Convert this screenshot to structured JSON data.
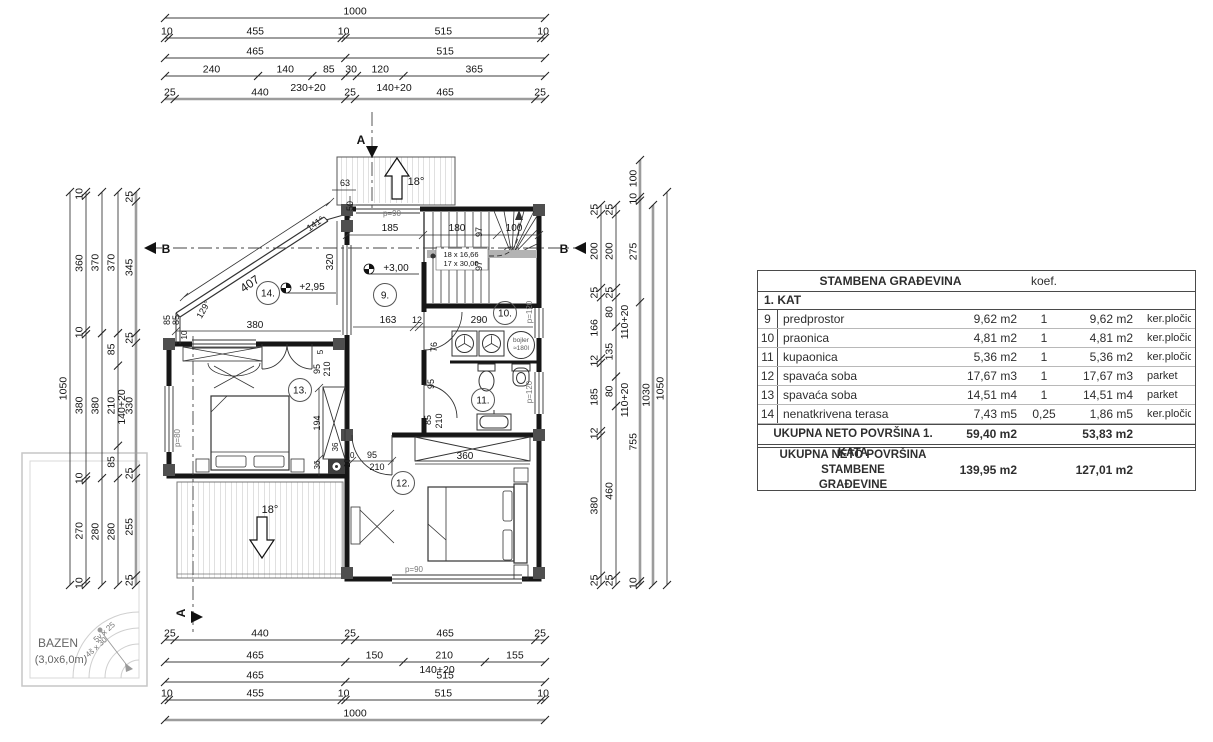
{
  "table": {
    "title": "STAMBENA GRAĐEVINA",
    "koef_header": "koef.",
    "section": "1. KAT",
    "rows": [
      {
        "n": "9",
        "name": "predprostor",
        "a": "9,62 m2",
        "k": "1",
        "a2": "9,62 m2",
        "f": "ker.pločice"
      },
      {
        "n": "10",
        "name": "praonica",
        "a": "4,81 m2",
        "k": "1",
        "a2": "4,81 m2",
        "f": "ker.pločice"
      },
      {
        "n": "11",
        "name": "kupaonica",
        "a": "5,36 m2",
        "k": "1",
        "a2": "5,36 m2",
        "f": "ker.pločice"
      },
      {
        "n": "12",
        "name": "spavaća soba",
        "a": "17,67 m3",
        "k": "1",
        "a2": "17,67 m3",
        "f": "parket"
      },
      {
        "n": "13",
        "name": "spavaća soba",
        "a": "14,51 m4",
        "k": "1",
        "a2": "14,51 m4",
        "f": "parket"
      },
      {
        "n": "14",
        "name": "nenatkrivena terasa",
        "a": "7,43 m5",
        "k": "0,25",
        "a2": "1,86 m5",
        "f": "ker.pločice"
      }
    ],
    "total1": {
      "label": "UKUPNA NETO POVRŠINA 1. KATA",
      "a": "59,40 m2",
      "a2": "53,83 m2"
    },
    "total2": {
      "label1": "UKUPNA NETO POVRŠINA STAMBENE",
      "label2": "GRAĐEVINE",
      "a": "139,95 m2",
      "a2": "127,01 m2"
    }
  },
  "dims": {
    "h": [
      {
        "y": 18,
        "x1": 165,
        "x2": 545,
        "segs": [
          "1000"
        ]
      },
      {
        "y": 38,
        "x1": 165,
        "x2": 545,
        "segs": [
          "10",
          "455",
          "10",
          "515",
          "10"
        ]
      },
      {
        "y": 58,
        "x1": 165,
        "x2": 545,
        "segs": [
          "465",
          "515"
        ]
      },
      {
        "y": 76,
        "x1": 165,
        "x2": 545,
        "segs": [
          "240",
          "140",
          "85",
          "30",
          "120",
          "365"
        ]
      },
      {
        "y": 99,
        "x1": 165,
        "x2": 545,
        "segs": [
          "25",
          "440",
          "25",
          "465",
          "25"
        ],
        "thick": true
      },
      {
        "y": 640,
        "x1": 165,
        "x2": 545,
        "segs": [
          "25",
          "440",
          "25",
          "465",
          "25"
        ]
      },
      {
        "y": 662,
        "x1": 165,
        "x2": 545,
        "segs": [
          "465",
          "150",
          "210",
          "155"
        ]
      },
      {
        "y": 682,
        "x1": 165,
        "x2": 545,
        "segs": [
          "465",
          "515"
        ]
      },
      {
        "y": 700,
        "x1": 165,
        "x2": 545,
        "segs": [
          "10",
          "455",
          "10",
          "515",
          "10"
        ]
      },
      {
        "y": 720,
        "x1": 165,
        "x2": 545,
        "segs": [
          "1000"
        ],
        "thick": true
      }
    ],
    "v": [
      {
        "x": 70,
        "y1": 192,
        "y2": 585,
        "segs": [
          "1050"
        ]
      },
      {
        "x": 86,
        "y1": 192,
        "y2": 585,
        "segs": [
          "10",
          "360",
          "10",
          "380",
          "10",
          "270",
          "10"
        ]
      },
      {
        "x": 102,
        "y1": 192,
        "y2": 585,
        "segs": [
          "370",
          "380",
          "280"
        ]
      },
      {
        "x": 118,
        "y1": 192,
        "y2": 585,
        "segs": [
          "370",
          "85",
          "210",
          "85",
          "280"
        ]
      },
      {
        "x": 136,
        "y1": 192,
        "y2": 585,
        "segs": [
          "25",
          "345",
          "25",
          "330",
          "25",
          "255",
          "25"
        ],
        "thick": true
      },
      {
        "x": 601,
        "y1": 205,
        "y2": 585,
        "segs": [
          "25",
          "200",
          "25",
          "166",
          "12",
          "185",
          "12",
          "380",
          "25"
        ]
      },
      {
        "x": 616,
        "y1": 205,
        "y2": 585,
        "segs": [
          "25",
          "200",
          "25",
          "80",
          "135",
          "80",
          "460",
          "25"
        ]
      },
      {
        "x": 640,
        "y1": 160,
        "y2": 585,
        "segs": [
          "100",
          "10",
          "275",
          "755",
          "10"
        ],
        "thick": true
      },
      {
        "x": 653,
        "y1": 205,
        "y2": 585,
        "segs": [
          "1030"
        ],
        "thick": true
      },
      {
        "x": 667,
        "y1": 192,
        "y2": 585,
        "segs": [
          "1050"
        ]
      }
    ],
    "extras": [
      {
        "t": "230+20",
        "x": 308,
        "y": 91
      },
      {
        "t": "140+20",
        "x": 394,
        "y": 91
      },
      {
        "t": "140+20",
        "x": 437,
        "y": 673
      },
      {
        "t": "140+20",
        "x": 125,
        "y": 407,
        "r": -90
      },
      {
        "t": "110+20",
        "x": 628,
        "y": 322,
        "r": -90
      },
      {
        "t": "110+20",
        "x": 628,
        "y": 400,
        "r": -90
      }
    ]
  },
  "plan": {
    "rooms": [
      {
        "n": "14.",
        "x": 268,
        "y": 293
      },
      {
        "n": "9.",
        "x": 385,
        "y": 295
      },
      {
        "n": "10.",
        "x": 505,
        "y": 313
      },
      {
        "n": "11.",
        "x": 483,
        "y": 400
      },
      {
        "n": "12.",
        "x": 403,
        "y": 483
      },
      {
        "n": "13.",
        "x": 300,
        "y": 390
      }
    ],
    "labels": [
      {
        "t": "407",
        "x": 252,
        "y": 287,
        "r": -35,
        "fs": 12
      },
      {
        "t": "141°",
        "x": 317,
        "y": 226,
        "r": -35,
        "fs": 9
      },
      {
        "t": "129°",
        "x": 206,
        "y": 311,
        "r": -60,
        "fs": 9
      },
      {
        "t": "63",
        "x": 345,
        "y": 186,
        "fs": 9
      },
      {
        "t": "50",
        "x": 353,
        "y": 206,
        "r": -90,
        "fs": 9
      },
      {
        "t": "320",
        "x": 333,
        "y": 262,
        "r": -90,
        "fs": 10
      },
      {
        "t": "380",
        "x": 255,
        "y": 328,
        "fs": 10
      },
      {
        "t": "85",
        "x": 170,
        "y": 320,
        "r": -90,
        "fs": 9
      },
      {
        "t": "85",
        "x": 179,
        "y": 320,
        "r": -90,
        "fs": 9
      },
      {
        "t": "10",
        "x": 187,
        "y": 335,
        "r": -90,
        "fs": 8
      },
      {
        "t": "+2,95",
        "x": 312,
        "y": 290,
        "fs": 10
      },
      {
        "t": "+3,00",
        "x": 396,
        "y": 271,
        "fs": 10
      },
      {
        "t": "p=90",
        "x": 392,
        "y": 216,
        "fs": 8,
        "col": "#787878"
      },
      {
        "t": "185",
        "x": 390,
        "y": 231,
        "fs": 10
      },
      {
        "t": "180",
        "x": 457,
        "y": 231,
        "fs": 10
      },
      {
        "t": "100",
        "x": 514,
        "y": 231,
        "fs": 10
      },
      {
        "t": "97",
        "x": 482,
        "y": 232,
        "r": -90,
        "fs": 9
      },
      {
        "t": "97",
        "x": 482,
        "y": 266,
        "r": -90,
        "fs": 9
      },
      {
        "t": "18 x 16,66",
        "x": 461,
        "y": 257,
        "fs": 7.5
      },
      {
        "t": "17 x 30,00",
        "x": 461,
        "y": 266,
        "fs": 7.5
      },
      {
        "t": "163",
        "x": 388,
        "y": 323,
        "fs": 10
      },
      {
        "t": "12",
        "x": 417,
        "y": 323,
        "fs": 9
      },
      {
        "t": "290",
        "x": 479,
        "y": 323,
        "fs": 10
      },
      {
        "t": "p=120",
        "x": 532,
        "y": 312,
        "r": -90,
        "fs": 8,
        "col": "#787878"
      },
      {
        "t": "p=120",
        "x": 532,
        "y": 392,
        "r": -90,
        "fs": 8,
        "col": "#787878"
      },
      {
        "t": "76",
        "x": 437,
        "y": 347,
        "r": -90,
        "fs": 9
      },
      {
        "t": "bojler",
        "x": 521,
        "y": 342,
        "fs": 6.5,
        "col": "#555555"
      },
      {
        "t": "≈180l",
        "x": 521,
        "y": 350,
        "fs": 6.5,
        "col": "#555555"
      },
      {
        "t": "95",
        "x": 434,
        "y": 384,
        "r": -90,
        "fs": 9
      },
      {
        "t": "85",
        "x": 431,
        "y": 420,
        "r": -90,
        "fs": 9
      },
      {
        "t": "210",
        "x": 442,
        "y": 421,
        "r": -90,
        "fs": 9
      },
      {
        "t": "10",
        "x": 350,
        "y": 458,
        "fs": 8
      },
      {
        "t": "95",
        "x": 372,
        "y": 458,
        "fs": 9
      },
      {
        "t": "210",
        "x": 377,
        "y": 470,
        "fs": 9
      },
      {
        "t": "360",
        "x": 465,
        "y": 459,
        "fs": 10
      },
      {
        "t": "p=90",
        "x": 414,
        "y": 572,
        "fs": 8,
        "col": "#787878"
      },
      {
        "t": "5",
        "x": 323,
        "y": 352,
        "r": -90,
        "fs": 8
      },
      {
        "t": "95",
        "x": 320,
        "y": 369,
        "r": -90,
        "fs": 9
      },
      {
        "t": "210",
        "x": 330,
        "y": 369,
        "r": -90,
        "fs": 9
      },
      {
        "t": "194",
        "x": 320,
        "y": 423,
        "r": -90,
        "fs": 9
      },
      {
        "t": "36",
        "x": 338,
        "y": 447,
        "r": -90,
        "fs": 8
      },
      {
        "t": "36",
        "x": 320,
        "y": 465,
        "r": -90,
        "fs": 8
      },
      {
        "t": "10",
        "x": 350,
        "y": 463,
        "r": -90,
        "fs": 8
      },
      {
        "t": "p=80",
        "x": 180,
        "y": 438,
        "r": -90,
        "fs": 8,
        "col": "#787878"
      },
      {
        "t": "18°",
        "x": 270,
        "y": 513,
        "fs": 11
      },
      {
        "t": "18°",
        "x": 416,
        "y": 185,
        "fs": 11
      },
      {
        "t": "B",
        "x": 166,
        "y": 253,
        "fs": 12,
        "b": 1
      },
      {
        "t": "B",
        "x": 564,
        "y": 253,
        "fs": 12,
        "b": 1
      },
      {
        "t": "A",
        "x": 361,
        "y": 144,
        "fs": 12,
        "b": 1
      },
      {
        "t": "A",
        "x": 185,
        "y": 613,
        "r": -90,
        "fs": 12,
        "b": 1
      },
      {
        "t": "BAZEN",
        "x": 58,
        "y": 647,
        "fs": 12,
        "col": "#666666"
      },
      {
        "t": "(3,0x6,0m)",
        "x": 61,
        "y": 663,
        "fs": 11,
        "col": "#666666"
      },
      {
        "t": "5v x 25",
        "x": 106,
        "y": 634,
        "r": -42,
        "fs": 8,
        "col": "#777777"
      },
      {
        "t": "4š x 30",
        "x": 98,
        "y": 649,
        "r": -42,
        "fs": 8,
        "col": "#777777"
      }
    ]
  }
}
